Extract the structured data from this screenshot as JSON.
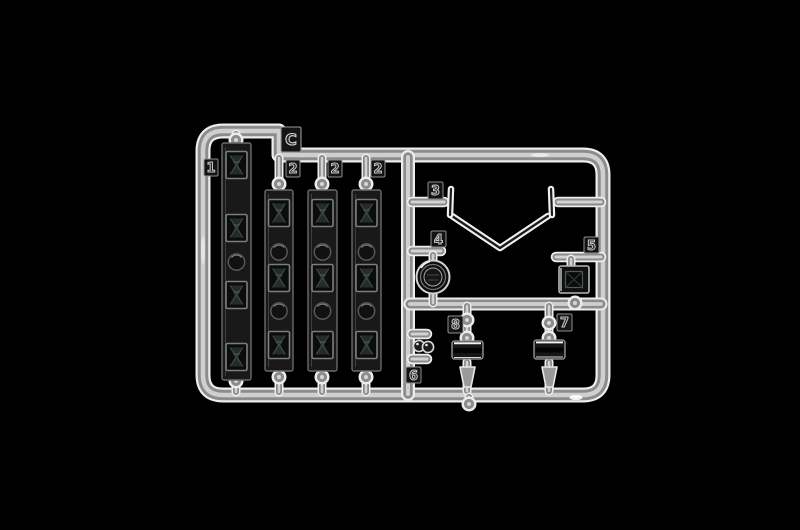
{
  "photo": {
    "subject": "Clear transparent plastic model-kit sprue (parts runner) photographed on a black background",
    "background_color": "#000000",
    "palette": {
      "plastic_highlight": "#eeeeee",
      "plastic_mid": "#8c8c8c",
      "plastic_sheen": "#cfcfcf",
      "dark_part": "#161616"
    }
  },
  "runner": {
    "letter": "C"
  },
  "tags": {
    "c": "C",
    "n1": "1",
    "n2a": "2",
    "n2b": "2",
    "n2c": "2",
    "n3": "3",
    "n4": "4",
    "n5": "5",
    "n6": "6",
    "n7": "7",
    "n8": "8"
  },
  "parts": [
    {
      "number": "1",
      "description": "long strip with faceted rectangular lenses and round dimples"
    },
    {
      "number": "2",
      "description": "long strip with faceted rectangular lenses (three copies)"
    },
    {
      "number": "3",
      "description": "V-shaped clear frame with upturned end posts"
    },
    {
      "number": "4",
      "description": "round lens"
    },
    {
      "number": "5",
      "description": "square faceted lens"
    },
    {
      "number": "6",
      "description": "pair of small round lights"
    },
    {
      "number": "7",
      "description": "small cylindrical light"
    },
    {
      "number": "8",
      "description": "small cylindrical light"
    }
  ]
}
